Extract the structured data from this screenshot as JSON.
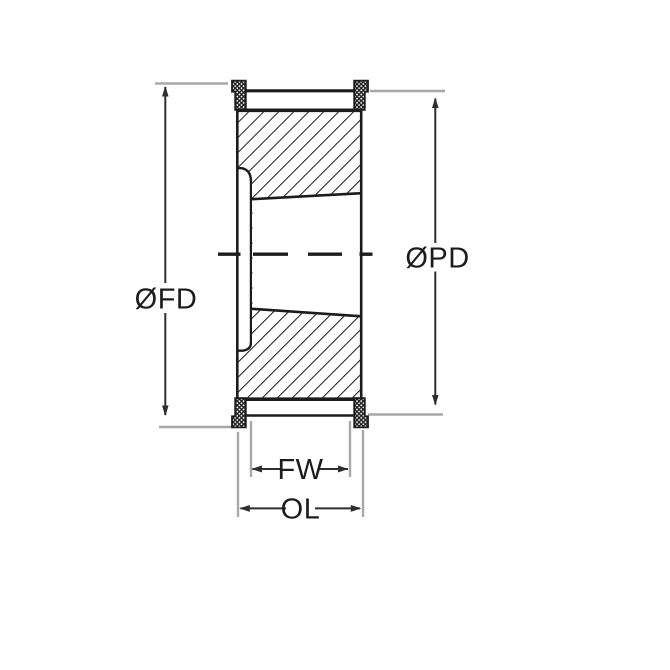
{
  "drawing": {
    "labels": {
      "flange_diameter": "ØFD",
      "pitch_diameter": "ØPD",
      "face_width": "FW",
      "overall_length": "OL"
    },
    "colors": {
      "line": "#1c1c1c",
      "extension_line": "#a8a8a8",
      "dimension_line": "#2e2e2e",
      "background": "#ffffff"
    }
  }
}
